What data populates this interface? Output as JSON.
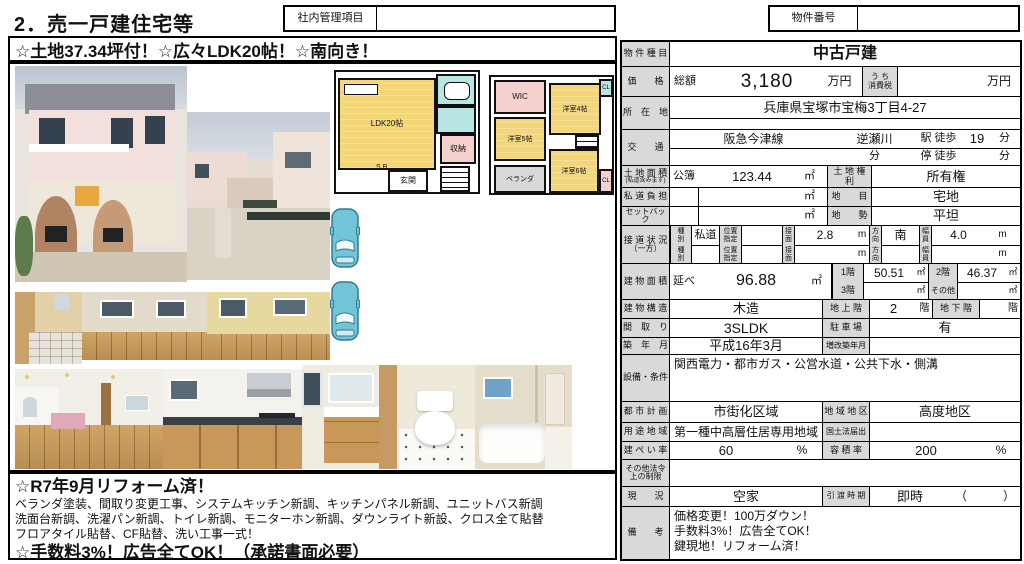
{
  "page": {
    "title": "2．売一戸建住宅等",
    "internal_label": "社内管理項目",
    "property_no_label": "物件番号",
    "catch_copy": "☆土地37.34坪付！☆広々LDK20帖！☆南向き！"
  },
  "floorplan": {
    "f1": {
      "ldk": "LDK20帖",
      "storage": "収納",
      "entrance": "玄関",
      "sb": "S.B"
    },
    "f2": {
      "wic": "WIC",
      "room4": "洋室4帖",
      "room5": "洋室5帖",
      "room6": "洋室6帖",
      "balcony": "ベランダ",
      "cl_top": "CL",
      "cl_bottom": "CL"
    }
  },
  "table": {
    "property_type": {
      "label": "物 件 種 目",
      "value": "中古戸建"
    },
    "price": {
      "label": "価　　格",
      "total_label": "総額",
      "value": "3,180",
      "unit": "万円",
      "tax_label": "う ち\n消費税",
      "tax_unit": "万円"
    },
    "address": {
      "label": "所　在　地",
      "value": "兵庫県宝塚市宝梅3丁目4-27"
    },
    "access": {
      "label": "交　　通",
      "line": "阪急今津線",
      "station": "逆瀬川",
      "walk_label": "駅 徒歩",
      "walk_min": "19",
      "min_unit": "分",
      "bus_min_unit": "分",
      "stop_label": "停 徒歩",
      "stop_min_unit": "分"
    },
    "land_area": {
      "label": "土 地 面 積",
      "note": "(私道含みます)",
      "register_label": "公簿",
      "value": "123.44",
      "unit": "㎡",
      "right_label": "土 地 権 利",
      "right_value": "所有権"
    },
    "private_road": {
      "label": "私 道 負 担",
      "unit": "㎡",
      "right_label": "地　　目",
      "right_value": "宅地"
    },
    "setback": {
      "label": "セットバック",
      "unit": "㎡",
      "right_label": "地　　勢",
      "right_value": "平坦"
    },
    "road": {
      "label": "接 道 状 況",
      "label2": "（一方）",
      "type_label": "種\n別",
      "pos_label": "位置\n指定",
      "face_label": "接\n面",
      "dir_label": "方\n向",
      "width_label": "幅\n員",
      "m": "m",
      "r1_type": "私道",
      "r1_face": "2.8",
      "r1_dir": "南",
      "r1_width": "4.0"
    },
    "building_area": {
      "label": "建 物 面 積",
      "total_label": "延べ",
      "value": "96.88",
      "sqm": "㎡",
      "f1_label": "1階",
      "f1": "50.51",
      "f2_label": "2階",
      "f2": "46.37",
      "f3_label": "3階",
      "other_label": "その他"
    },
    "structure": {
      "label": "建 物 構 造",
      "value": "木造",
      "above_label": "地 上 階",
      "above": "2",
      "floor_unit": "階",
      "below_label": "地 下 階"
    },
    "layout": {
      "label": "間　取　り",
      "value": "3SLDK",
      "parking_label": "駐 車 場",
      "parking": "有"
    },
    "built": {
      "label": "築　年　月",
      "value": "平成16年3月",
      "renov_label": "増改築年月"
    },
    "facilities": {
      "label": "設備・条件",
      "value": "関西電力・都市ガス・公営水道・公共下水・側溝"
    },
    "city_plan": {
      "label": "都 市 計 画",
      "value": "市街化区域",
      "district_label": "地 域 地 区",
      "district": "高度地区"
    },
    "use_district": {
      "label": "用 途 地 域",
      "value": "第一種中高層住居専用地域",
      "law_label": "国土法届出"
    },
    "coverage": {
      "label": "建 ぺ い 率",
      "value": "60",
      "unit": "%",
      "far_label": "容 積 率",
      "far": "200",
      "far_unit": "%"
    },
    "other_law": {
      "label": "その他法令\n上の制限"
    },
    "status": {
      "label": "現　　況",
      "value": "空家",
      "delivery_label": "引 渡 時 期",
      "delivery": "即時",
      "paren": "（　　　）"
    },
    "remarks": {
      "label": "備　　考",
      "lines": [
        "価格変更！100万ダウン！",
        "手数料3%！広告全てOK！",
        "鍵現地！リフォーム済！"
      ]
    }
  },
  "note": {
    "line1": "☆R7年9月リフォーム済！",
    "line2": "ベランダ塗装、間取り変更工事、システムキッチン新調、キッチンパネル新調、ユニットバス新調",
    "line3": "洗面台新調、洗濯パン新調、トイレ新調、モニターホン新調、ダウンライト新設、クロス全て貼替",
    "line4": "フロアタイル貼替、CF貼替、洗い工事一式！",
    "line5": "☆手数料3%！広告全てOK！（承諾書面必要）"
  }
}
